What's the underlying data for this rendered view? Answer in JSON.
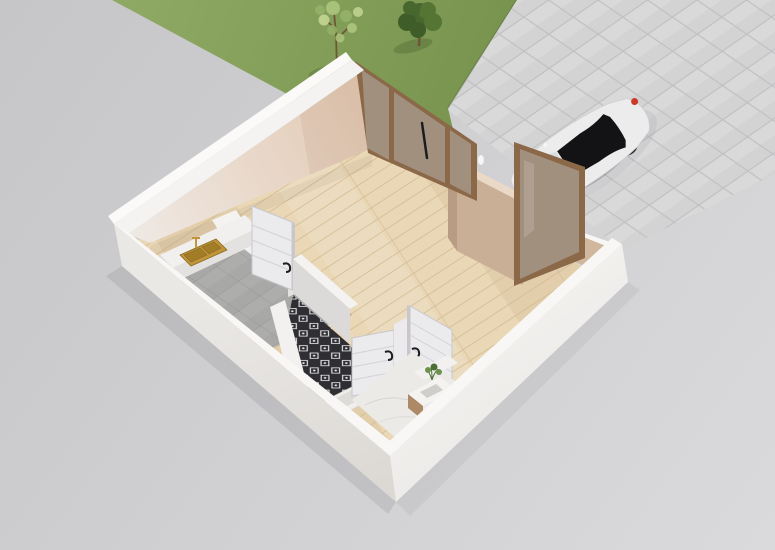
{
  "meta": {
    "description": "3D isometric cutaway floor-plan rendering of a small studio apartment with entry glass doors, kitchen nook with brass sink, patterned-tile bathroom, marble bath with vanity, surrounded by a lawn with two trees and a paved driveway with a parked white car",
    "width_px": 775,
    "height_px": 550
  },
  "elements": {
    "outdoor": [
      "lawn",
      "small-tree",
      "large-tree",
      "paver-driveway",
      "white-car"
    ],
    "building": [
      "perimeter-walls",
      "wood-floor-living-area",
      "entry-glass-doors",
      "entry-partition-wall",
      "entry-glass-panel",
      "kitchen-counter",
      "brass-kitchen-sink",
      "gray-tile-kitchen-floor",
      "kitchen-door",
      "patterned-tile-toilet-floor",
      "mop-basin",
      "bathroom-door-left",
      "bathroom-door-right",
      "marble-bathroom-floor",
      "vanity-with-plant"
    ]
  },
  "colors": {
    "background_top": "#c6c6c8",
    "background_bottom": "#dadadc",
    "lawn_light": "#8ea964",
    "lawn_dark": "#75914b",
    "lawn_edge_shadow": "rgba(30,45,15,0.18)",
    "tree_trunk": "#6f5638",
    "tree_dark_1": "#47672e",
    "tree_dark_2": "#3f5d28",
    "tree_dark_3": "#557534",
    "tree_light_1": "#adc57e",
    "tree_light_2": "#c3d693",
    "tree_light_3": "#94b269",
    "paver_tile": "#d3d3d4",
    "paver_grout": "#c0c0c2",
    "shadow_soft": "rgba(75,75,80,0.12)",
    "shadow_softer": "rgba(75,75,80,0.07)",
    "car_shadow": "rgba(85,85,90,0.30)",
    "car_body": "#ececed",
    "car_body_line": "#cfcfd3",
    "car_glass": "#131316",
    "car_windshield": "#d9dde0",
    "car_roof_gap": "#e6e8ea",
    "car_taillight": "#cd3a28",
    "car_wheel": "#2c2c2f",
    "car_hub": "#8b8b8e",
    "wall_outer_bright": "#fbfaf9",
    "wall_top": "#f4f3f1",
    "wall_top_bright": "#f8f7f5",
    "wall_sw_light": "#eae8e5",
    "wall_sw_dark": "#dcd9d5",
    "wall_se_light": "#f3f2f0",
    "wall_se_dark": "#e9e7e4",
    "wall_beige_west": "#efe9e4",
    "wall_beige_north": "#e3c9b2",
    "wall_beige_shade": "rgba(150,110,85,0.10)",
    "partition_face": "#c8af96",
    "partition_top": "#ead9c7",
    "partition_side": "#b89d84",
    "wedge_beige": "#d1b79e",
    "bronze": "#8a6848",
    "glass_tint": "rgba(195,200,204,0.42)",
    "glass_streak": "rgba(255,255,255,0.14)",
    "wood_base": "#e9d7b6",
    "wood_gap": "#d5bd95",
    "wood_tint_dark": "rgba(165,125,75,0.10)",
    "wood_tint_light": "rgba(255,255,255,0.12)",
    "wood_wall_shadow": "rgba(60,50,40,0.06)",
    "gray_tile": "#a8a8a6",
    "gray_tile_line": "#96969a",
    "counter_white": "#f1f0ee",
    "counter_front": "#e3e2e0",
    "counter_side": "#dcdbd9",
    "sink_brass": "#c0953c",
    "sink_brass_dark": "#a37c28",
    "sink_brass_deep": "#8a6a1e",
    "motif_dark": "#2e2e33",
    "motif_light": "#e9e9eb",
    "marble": "#eceae6",
    "marble_vein": "#d2d0cc",
    "door_white": "#ebebed",
    "door_groove": "#d2d2d7",
    "door_edge": "#c7c7cc",
    "door_handle": "#1c1c1e",
    "wall_b_face": "#dbdad8",
    "wall_lit": "#f2f1ef",
    "stub_white": "#eceaec",
    "basin_rim": "#f0efed",
    "basin_inner": "#dddcd9",
    "basin_line": "#d8d7d5",
    "vanity_top": "#f4f3f1",
    "vanity_front": "#eceae8",
    "vanity_wood": "#ad8a66",
    "vanity_slot": "#cfcecb",
    "plant_dark": "#4e7036",
    "plant_light": "#6f9150",
    "white_accent": "#f6f6f6"
  }
}
